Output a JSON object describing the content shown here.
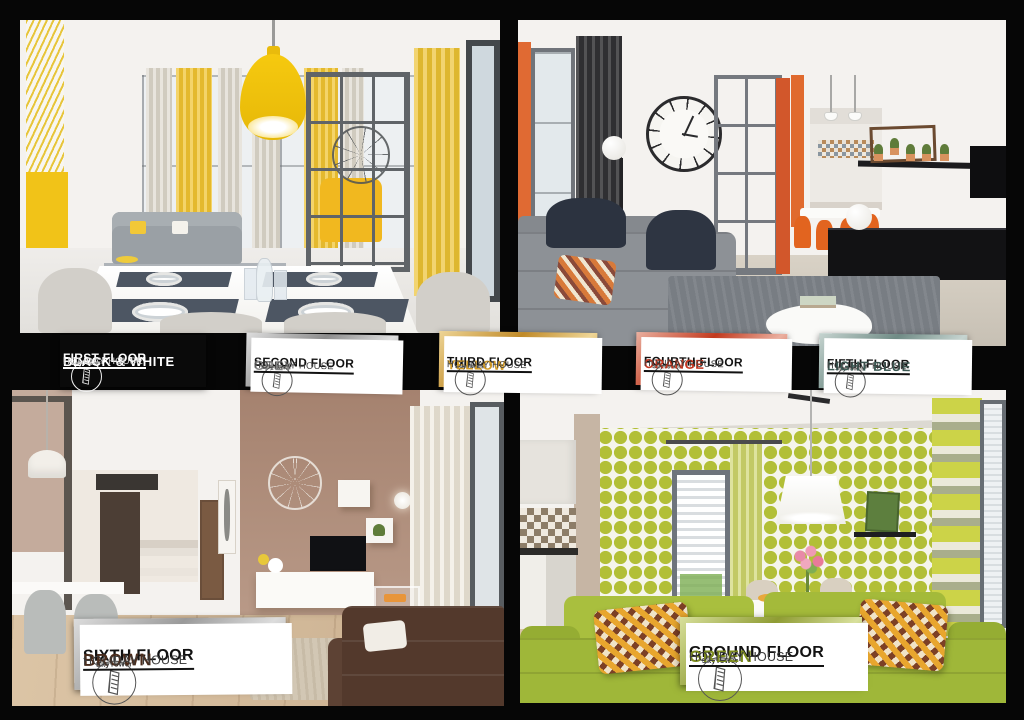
{
  "brand": {
    "name": "SkyTower"
  },
  "page": {
    "background": "#060606"
  },
  "labels": [
    {
      "floor": "FIRST FLOOR",
      "color_name": "BLACK & WHITE",
      "suffix": "HOLIDAY HOUSE",
      "theme": "black",
      "color_hex": "#ffffff",
      "frame_colors": [
        "#0a0a0a",
        "#0a0a0a"
      ]
    },
    {
      "floor": "SECOND FLOOR",
      "color_name": "GREY",
      "suffix": "HOLIDAY HOUSE",
      "theme": "frame",
      "color_hex": "#858585",
      "frame_colors": [
        "#dedede",
        "#8c8c8c"
      ]
    },
    {
      "floor": "THIRD FLOOR",
      "color_name": "YELLOW",
      "suffix": "HOLIDAY HOUSE",
      "theme": "frame",
      "color_hex": "#d29b26",
      "frame_colors": [
        "#eed596",
        "#c08a28"
      ]
    },
    {
      "floor": "FOURTH FLOOR",
      "color_name": "ORANGE",
      "suffix": "HOLIDAY HOUSE",
      "theme": "frame",
      "color_hex": "#c2341e",
      "frame_colors": [
        "#eab0a0",
        "#c23a1e"
      ]
    },
    {
      "floor": "FIFTH FLOOR",
      "color_name": "LIGHT BLUE",
      "suffix": "HOLIDAY HOUSE",
      "theme": "frame",
      "color_hex": "#3c5a54",
      "frame_colors": [
        "#c6d4d0",
        "#6f8b85"
      ]
    },
    {
      "floor": "SIXTH FLOOR",
      "color_name": "BROWN",
      "suffix": "HOLIDAY HOUSE",
      "theme": "frame",
      "color_hex": "#4a2c1c",
      "frame_colors": [
        "#dcdcdc",
        "#9a9a9a"
      ]
    },
    {
      "floor": "GROUND FLOOR",
      "color_name": "GREEN",
      "suffix": "HOLIDAY HOUSE",
      "theme": "frame",
      "color_hex": "#7d8c1f",
      "frame_colors": [
        "#d8e09c",
        "#8f9c34"
      ]
    }
  ],
  "photos": [
    {
      "id": "first-floor-black-white",
      "accent": "#f1c318"
    },
    {
      "id": "fourth-floor-orange",
      "accent": "#e06a33"
    },
    {
      "id": "sixth-floor-brown",
      "accent": "#a5826f"
    },
    {
      "id": "ground-floor-green",
      "accent": "#b2bf37"
    }
  ]
}
